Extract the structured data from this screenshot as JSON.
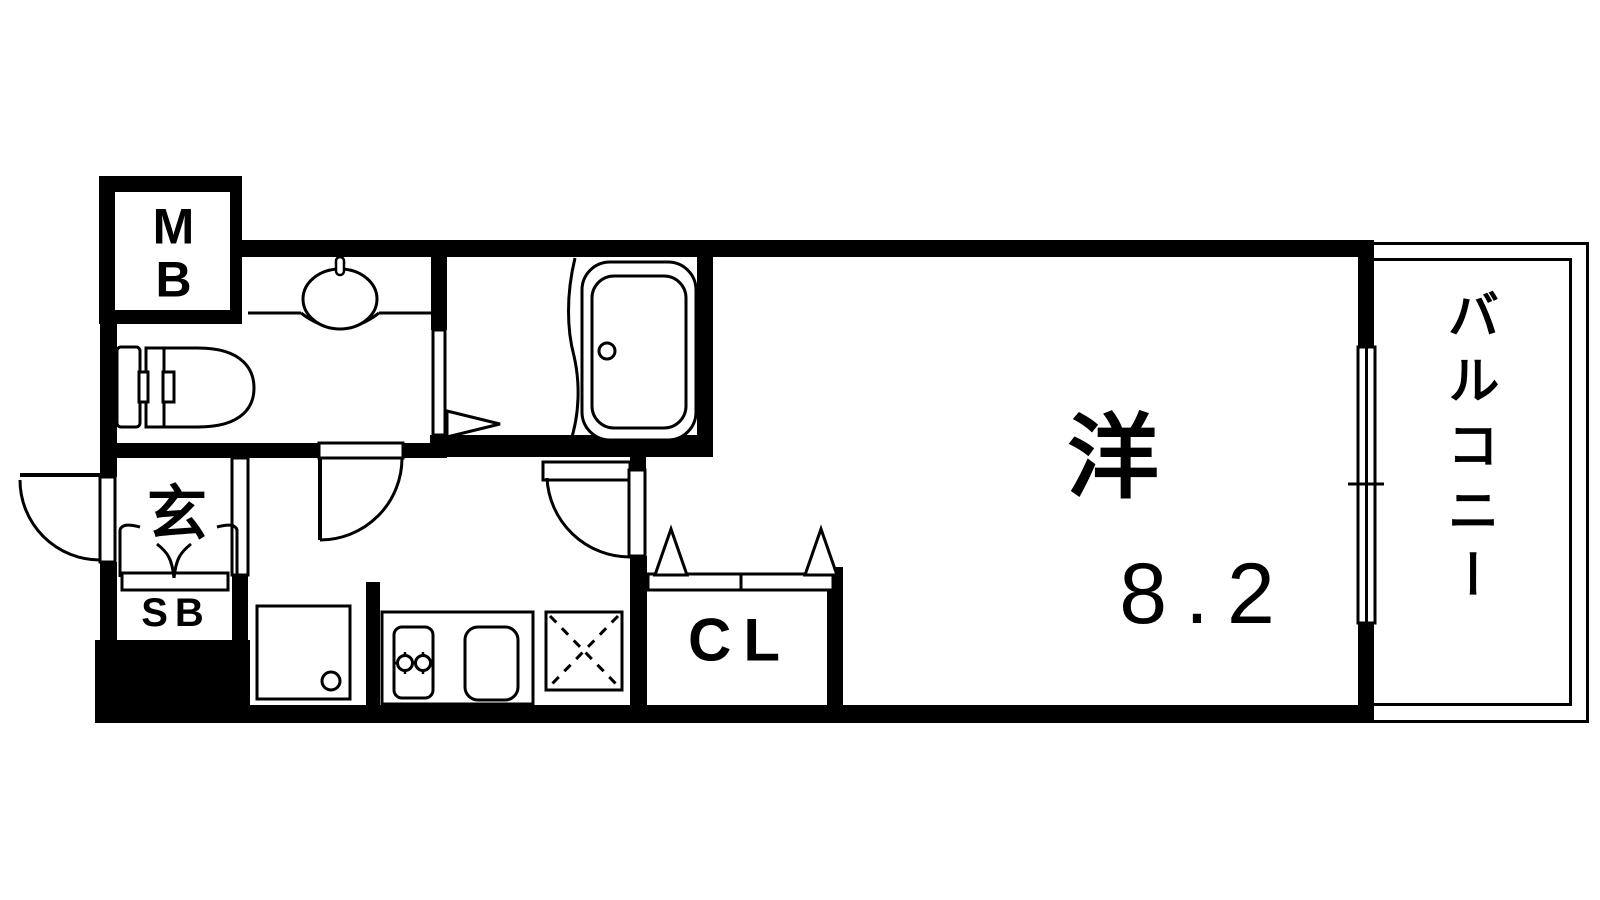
{
  "floorplan": {
    "meter_box": {
      "line1": "M",
      "line2": "B"
    },
    "entrance": {
      "label": "玄"
    },
    "shoe_box": {
      "label": "SB"
    },
    "closet": {
      "label": "CL"
    },
    "main_room": {
      "label": "洋",
      "size_tatami": "8.2"
    },
    "balcony": {
      "label": "バルコニー"
    }
  }
}
